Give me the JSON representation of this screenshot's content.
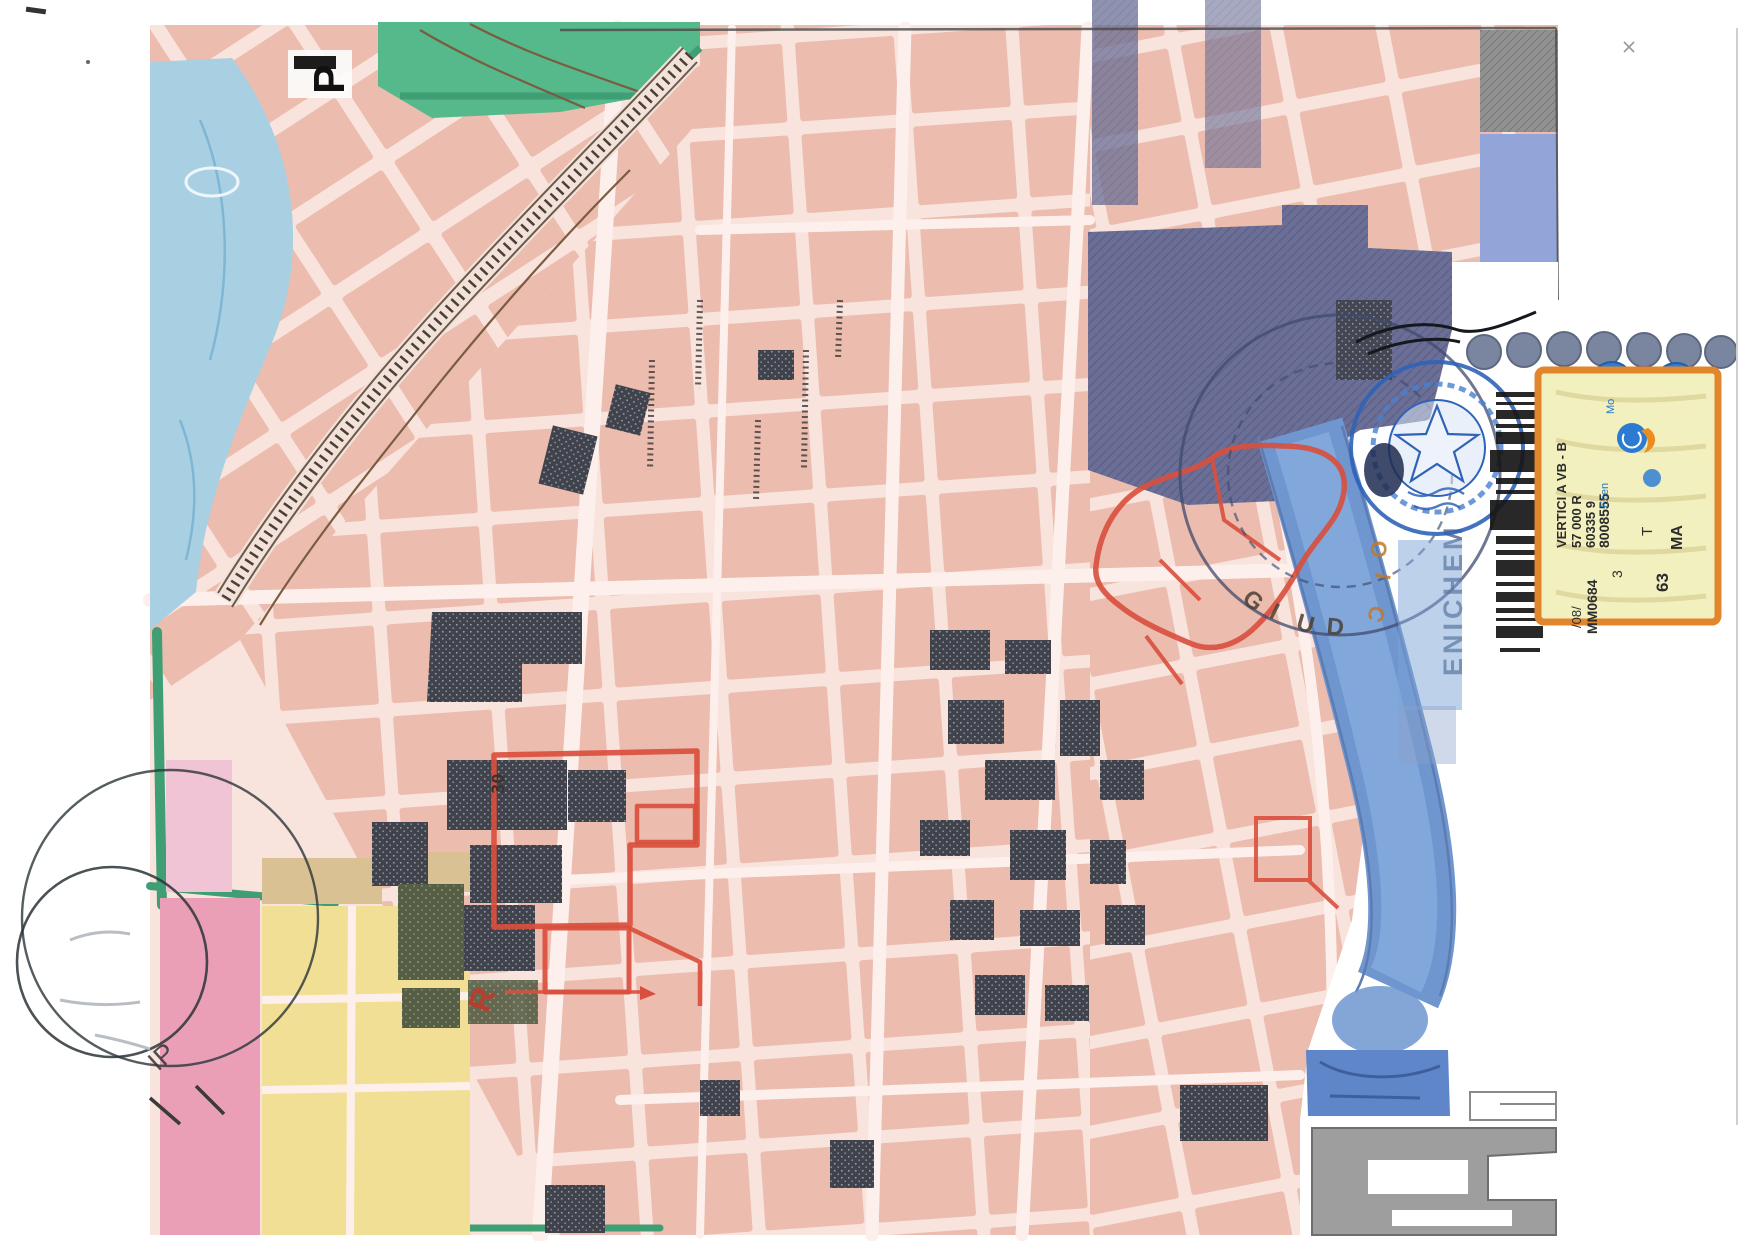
{
  "document": {
    "kind": "scanned cadastral city map with legal stamps",
    "orientation_note": "several labels rotated 90 degrees"
  },
  "palette": {
    "pageWhite": "#ffffff",
    "roadPink": "#f8e3dd",
    "roadLight": "#fdf0ec",
    "blockPink": "#ecbcae",
    "magentaBlock": "#ea9fb7",
    "yellowBlock": "#f2df96",
    "tanBlock": "#d9c193",
    "parkGreen": "#55b98b",
    "tealStrip": "#3f9e74",
    "waterLight": "#a9d0e2",
    "canalBlue": "#6f96cf",
    "periwinkle": "#93a4d8",
    "violetBlock": "#6b6f96",
    "greyBlock": "#919191",
    "charcoal": "#40434c",
    "oliveBlock": "#565f46",
    "redLine": "#d94f3d",
    "stampBlue": "#2f63b8",
    "stampInk": "#2e3a4e",
    "orangeArc": "#c07a2b",
    "stickerBg": "#f3f0bf",
    "stickerBorder": "#e1862c",
    "barcodeInk": "#161616",
    "dockGrey": "#9e9e9e",
    "inkDark": "#222222"
  },
  "map": {
    "parking_label": "P",
    "parcel_number": "30",
    "red_annotation_letter": "R",
    "company_watermark": "ENICHEM"
  },
  "stamps": {
    "bottom_left_letters": "IP",
    "court_arc_letters_dark": "GIUD",
    "court_arc_letters_orange": "OIC"
  },
  "sticker": {
    "line_code1": "8008555",
    "line_code2": "60335 9",
    "line_code3": "57 000 R",
    "line_vertici": "VERTICI A VB - B",
    "line_code4": "MM0684",
    "line_code5": "/08/",
    "line_code6": "3",
    "code_ma": "MA",
    "code_t": "T",
    "code_63": "63",
    "code_3": "3",
    "small_label1": "Mo",
    "small_label2": "Ecen"
  }
}
